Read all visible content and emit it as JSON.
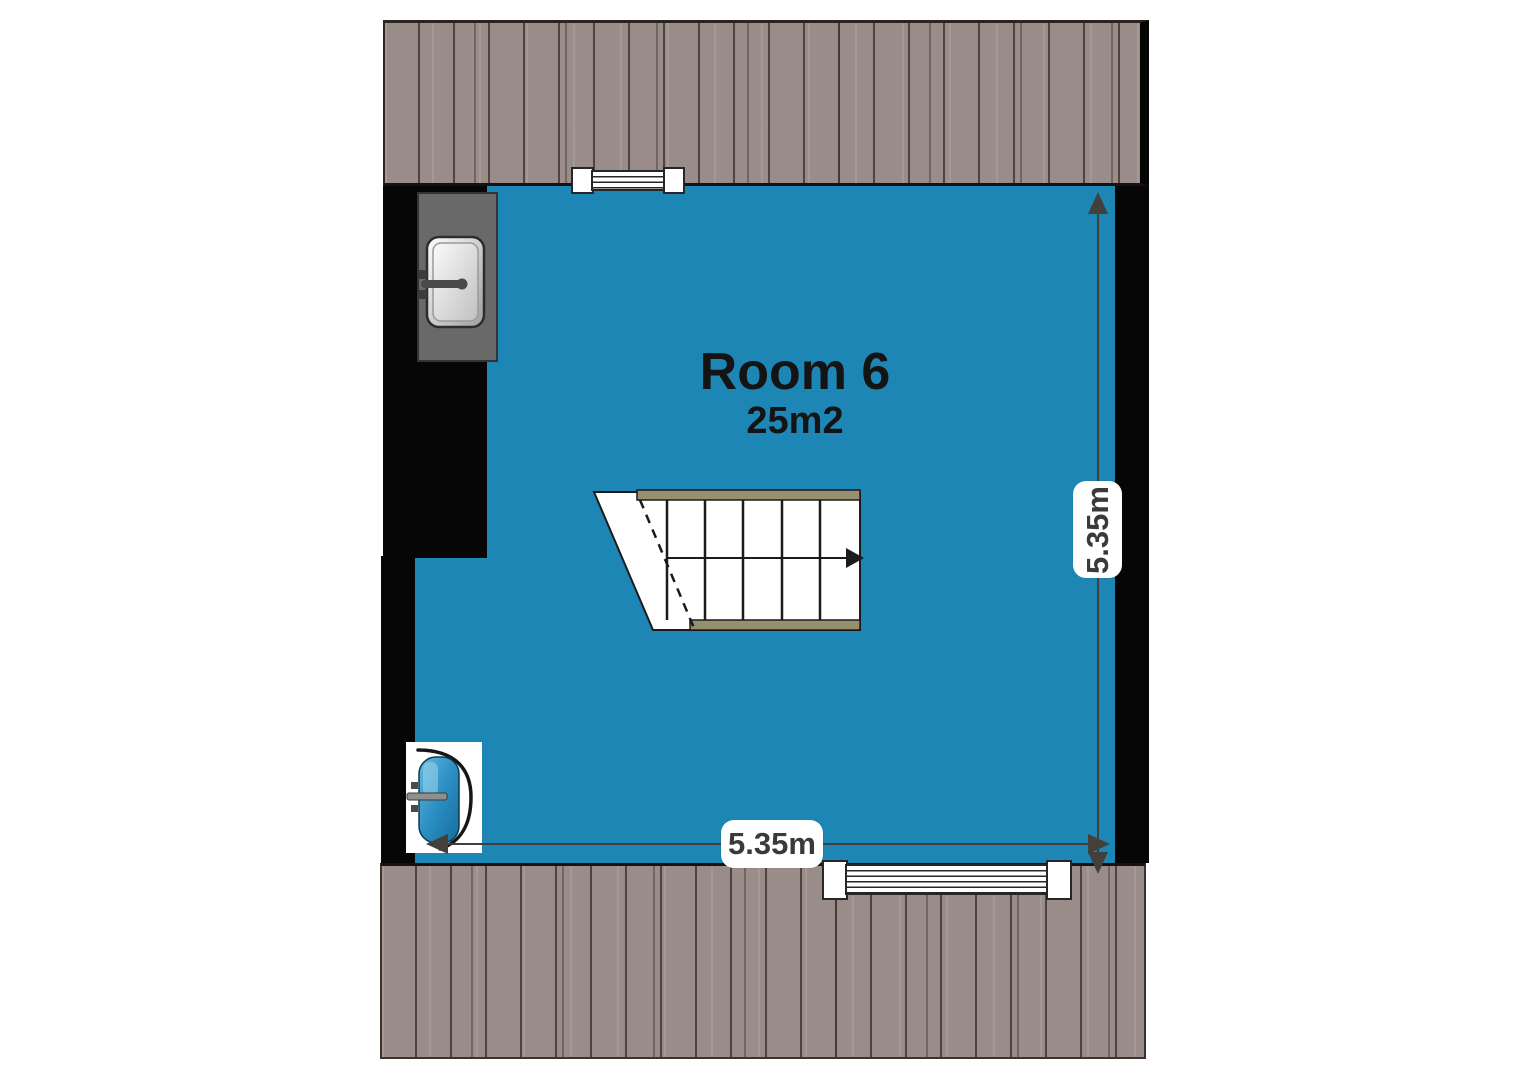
{
  "floorplan": {
    "room": {
      "name": "Room 6",
      "area": "25m2"
    },
    "dimensions": {
      "width": "5.35m",
      "height": "5.35m"
    },
    "colors": {
      "room_fill": "#1e86b5",
      "roof_fill": "#9a8d89",
      "roof_plank_line": "#6b5f5a",
      "wall_fill": "#060606",
      "counter_fill": "#696969",
      "stair_stringer": "#97906f",
      "door_fill": "#2f93c4",
      "dimension_line": "#43403c",
      "label_background": "#ffffff",
      "label_text": "#3a3a3a",
      "title_text": "#141414"
    },
    "fixtures": [
      {
        "icon": "sink-icon"
      },
      {
        "icon": "door-icon"
      },
      {
        "icon": "stairs-icon"
      },
      {
        "icon": "window-icon",
        "position": "top"
      },
      {
        "icon": "window-icon",
        "position": "bottom"
      }
    ]
  }
}
